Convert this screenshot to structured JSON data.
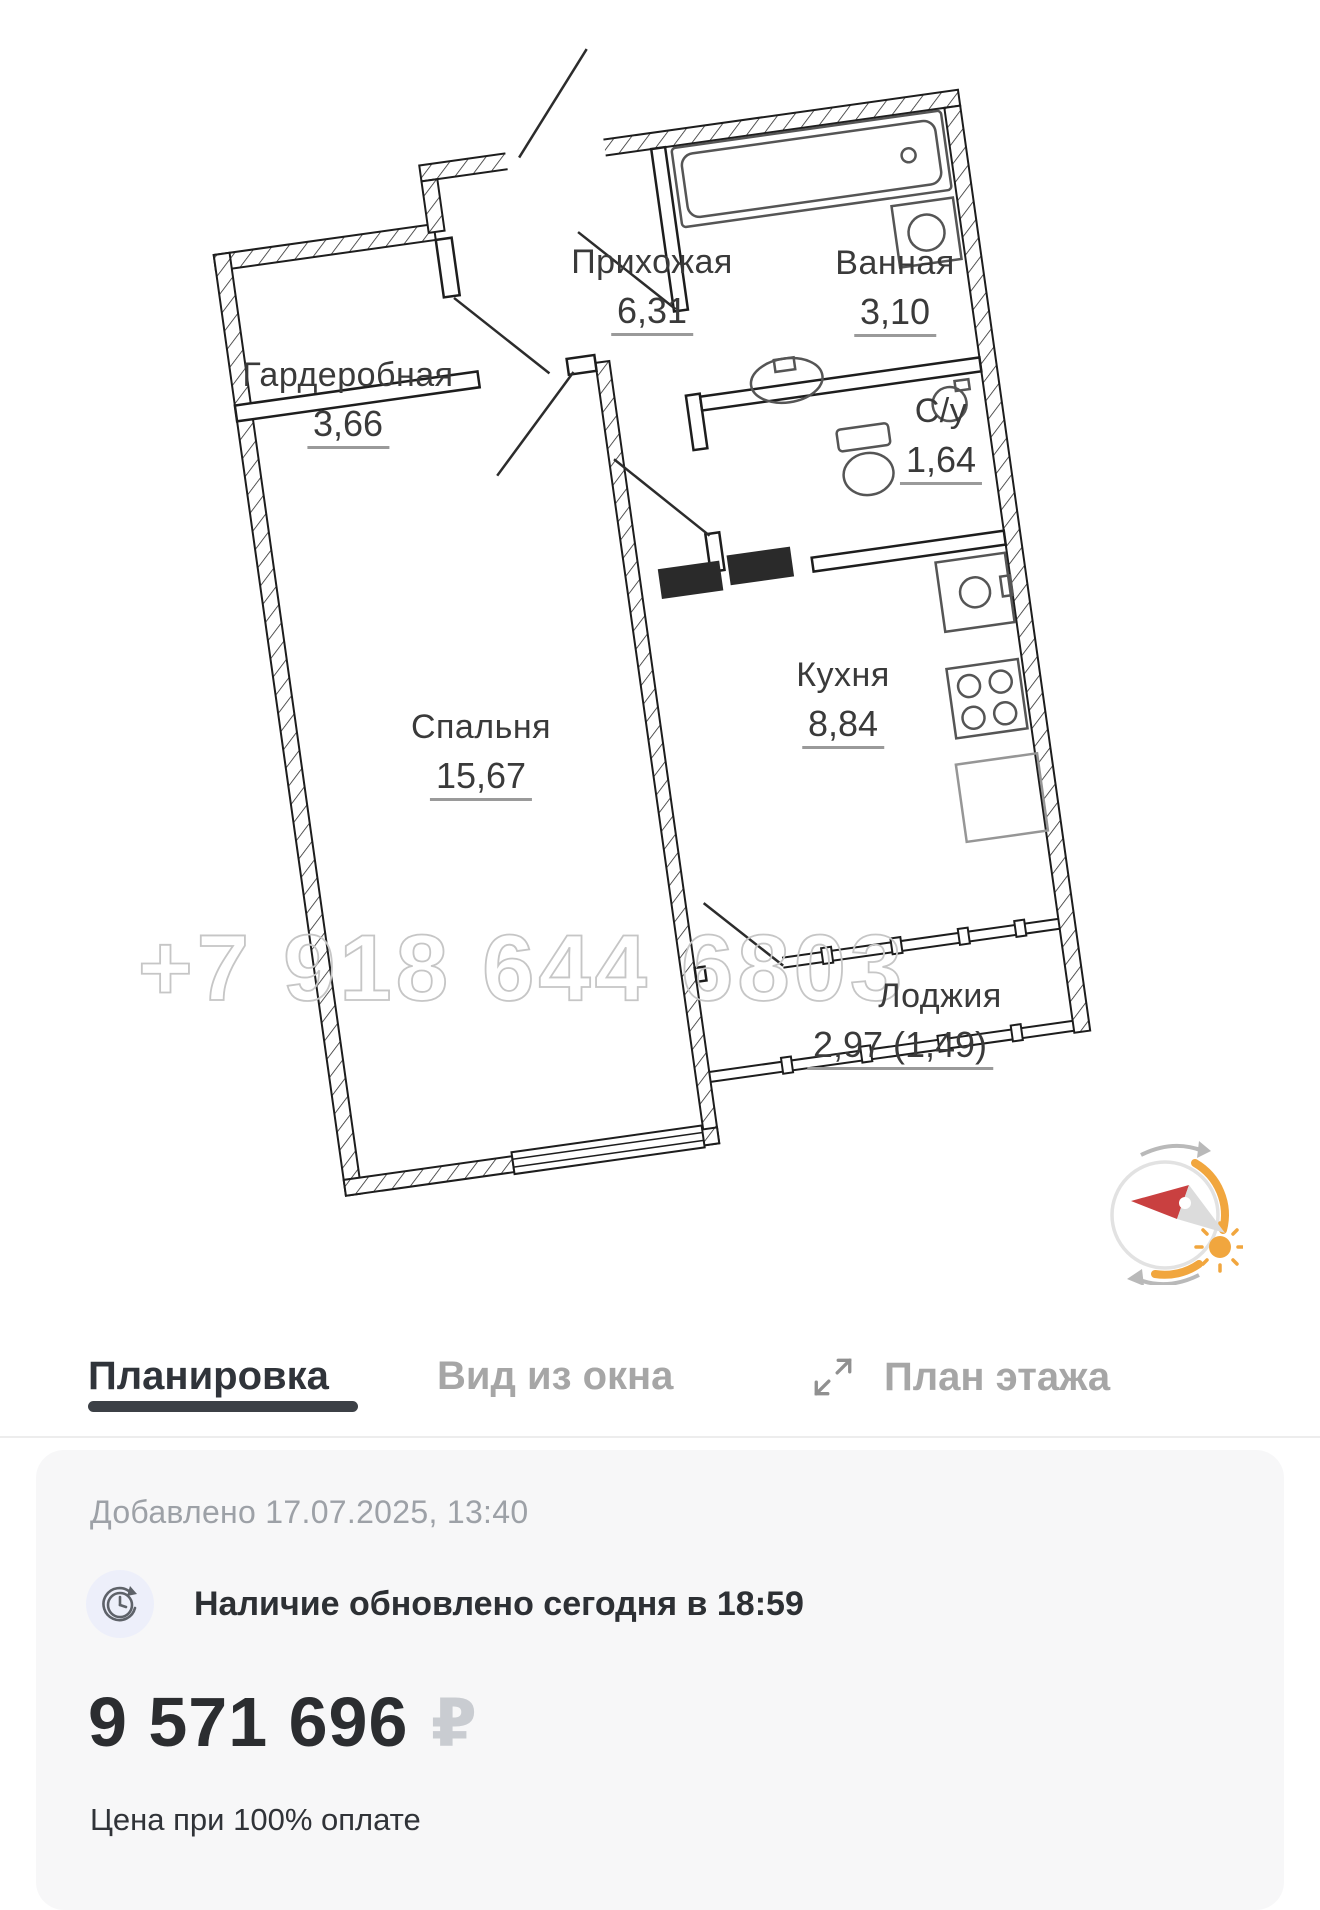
{
  "plan": {
    "watermark": "+7 918 644 6803",
    "rooms": {
      "wardrobe": {
        "name": "Гардеробная",
        "area": "3,66"
      },
      "hall": {
        "name": "Прихожая",
        "area": "6,31"
      },
      "bath": {
        "name": "Ванная",
        "area": "3,10"
      },
      "wc": {
        "name": "С/у",
        "area": "1,64"
      },
      "bedroom": {
        "name": "Спальня",
        "area": "15,67"
      },
      "kitchen": {
        "name": "Кухня",
        "area": "8,84"
      },
      "loggia": {
        "name": "Лоджия",
        "area": "2,97 (1,49)"
      }
    }
  },
  "tabs": [
    {
      "label": "Планировка",
      "active": true
    },
    {
      "label": "Вид из окна",
      "active": false
    },
    {
      "label": "План этажа",
      "active": false
    }
  ],
  "listing": {
    "added": "Добавлено 17.07.2025, 13:40",
    "availability": "Наличие обновлено сегодня в 18:59",
    "price": "9 571 696",
    "currency": "₽",
    "payment_note": "Цена при 100% оплате"
  },
  "colors": {
    "accent_orange": "#F1A63E",
    "needle_red": "#C94040",
    "active_tab": "#30343A",
    "inactive_tab": "#A6A6A6",
    "watermark_gray": "#C6C6C6",
    "card_bg": "#F7F7F8"
  }
}
